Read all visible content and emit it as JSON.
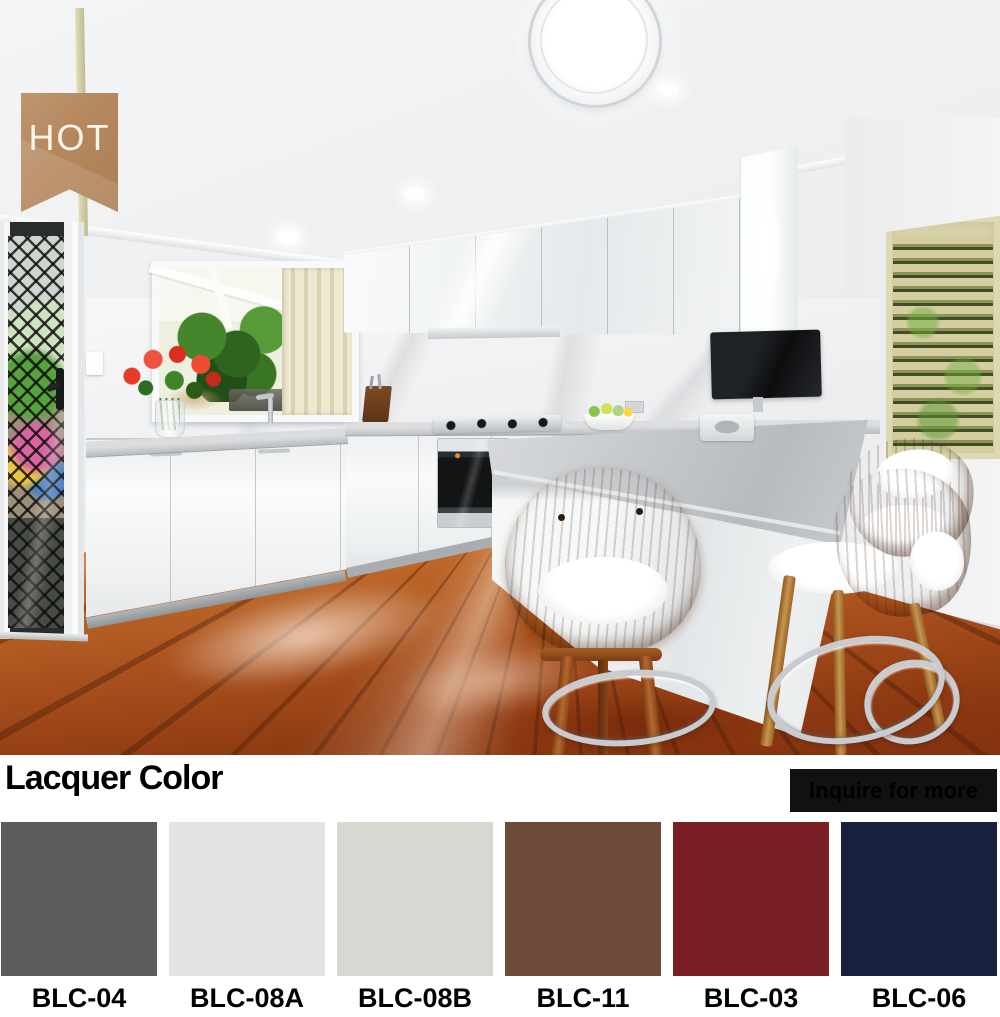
{
  "badge": {
    "label": "HOT",
    "bg_color": "#b5875c",
    "text_color": "#fdf5e8"
  },
  "lacquer_section": {
    "title": "Lacquer Color",
    "inquire_button": {
      "label": "Inquire for more",
      "bg_color": "#111111",
      "text_color": "#ffffff"
    }
  },
  "swatches": [
    {
      "code": "BLC-04",
      "hex": "#5b5c5e"
    },
    {
      "code": "BLC-08A",
      "hex": "#e2e3e5"
    },
    {
      "code": "BLC-08B",
      "hex": "#d8d7d2"
    },
    {
      "code": "BLC-11",
      "hex": "#6e4a38"
    },
    {
      "code": "BLC-03",
      "hex": "#7a2025"
    },
    {
      "code": "BLC-06",
      "hex": "#1a2140"
    }
  ]
}
